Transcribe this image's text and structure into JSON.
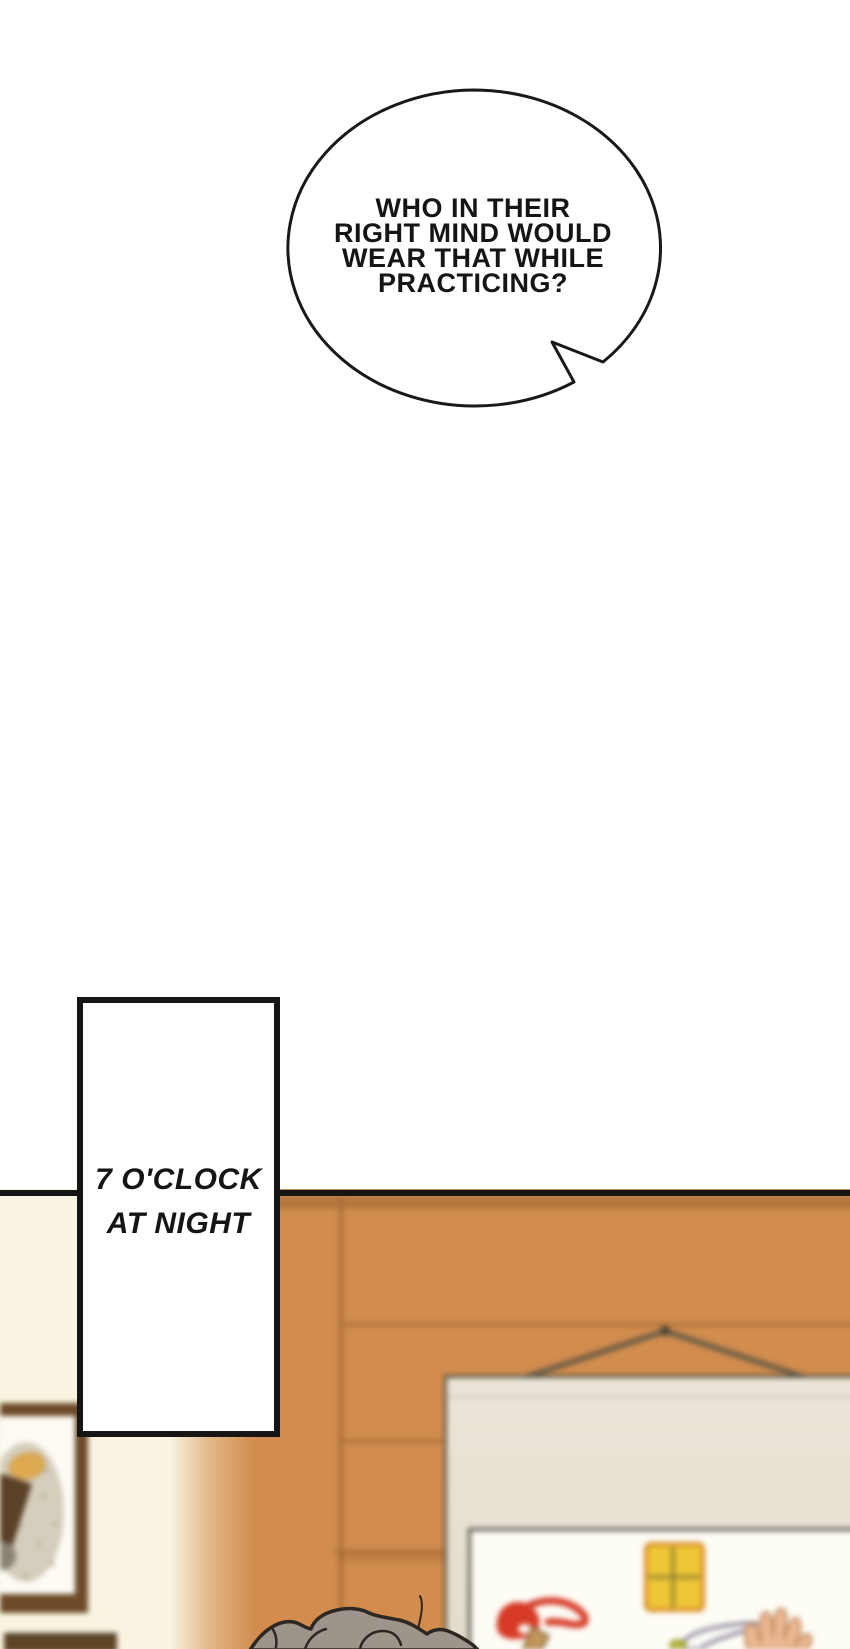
{
  "bubble": {
    "lines": [
      "WHO IN THEIR",
      "RIGHT MIND WOULD",
      "WEAR THAT WHILE",
      "PRACTICING?"
    ]
  },
  "caption": {
    "lines": [
      "7 O'CLOCK",
      "AT NIGHT"
    ]
  },
  "colors": {
    "ink": "#161514",
    "paper": "#ffffff",
    "cream_wall": "#f9f4e1",
    "wood": "#d18c4e",
    "wood_dark_band": "#b5793f",
    "wood_seam": "#a86d35",
    "cord": "#5f5844",
    "scroll_margin": "#e8e3d6",
    "scroll_panel": "#fdfcf5",
    "scroll_edge": "#52503e",
    "frame_wood": "#6b4a28",
    "frame_matte": "#fdfbf4",
    "hair_fill": "#9d958b",
    "hair_line": "#2c2721"
  }
}
